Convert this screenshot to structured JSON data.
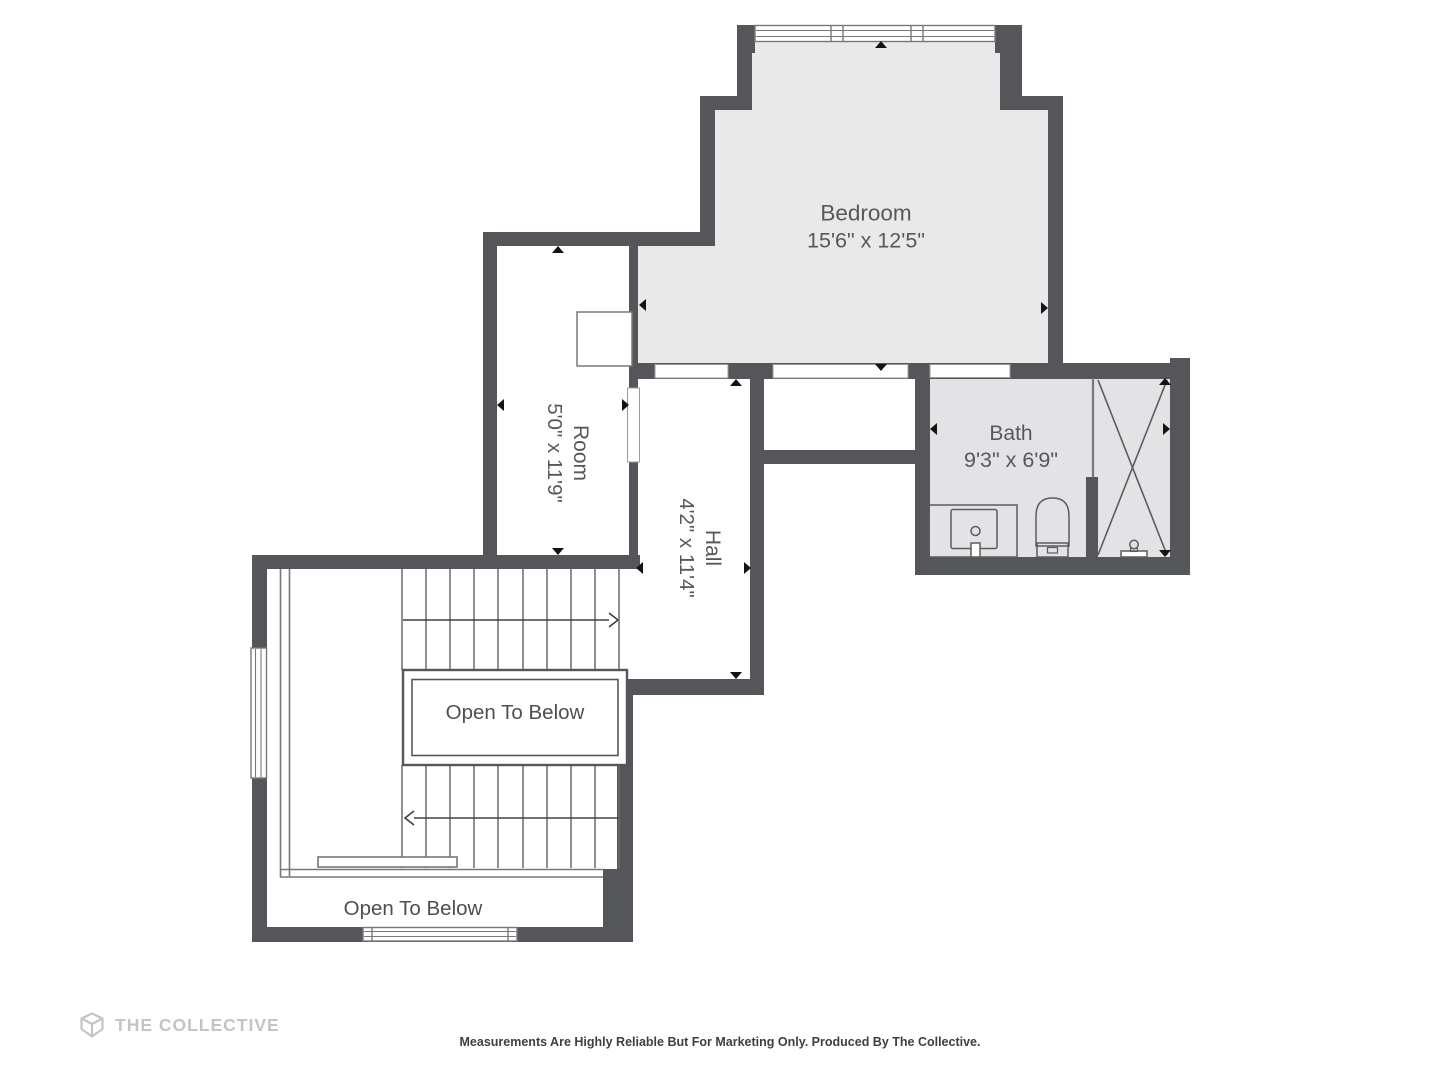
{
  "branding": {
    "logo_text": "THE COLLECTIVE",
    "logo_icon": "the-collective-logo-icon"
  },
  "footer": {
    "disclaimer": "Measurements Are Highly Reliable But For Marketing Only. Produced By The Collective."
  },
  "rooms": {
    "bedroom": {
      "name": "Bedroom",
      "dims": "15'6\" x 12'5\""
    },
    "room": {
      "name": "Room",
      "dims": "5'0\" x 11'9\""
    },
    "hall": {
      "name": "Hall",
      "dims": "4'2\" x 11'4\""
    },
    "bath": {
      "name": "Bath",
      "dims": "9'3\" x 6'9\""
    }
  },
  "voids": {
    "stairwell": {
      "label": "Open To Below"
    },
    "lower": {
      "label": "Open To Below"
    }
  },
  "colors": {
    "wall": "#54565a",
    "bedroom_floor": "#e9e9ea",
    "bath_floor": "#e3e3e5",
    "thin_line": "#77787a",
    "label_text": "#56585b",
    "arrow": "#141414",
    "logo": "#c4c4c5",
    "disclaimer_text": "#3e3f41"
  },
  "icons": {
    "logo_mark": "the-collective-logo-icon",
    "toilet": "toilet-icon",
    "sink": "sink-icon",
    "shower": "shower-icon",
    "shower_head": "shower-head-icon",
    "window": "window-icon",
    "stair_direction": "stair-direction-arrow-icon",
    "measure_arrow": "measure-arrow-icon"
  }
}
